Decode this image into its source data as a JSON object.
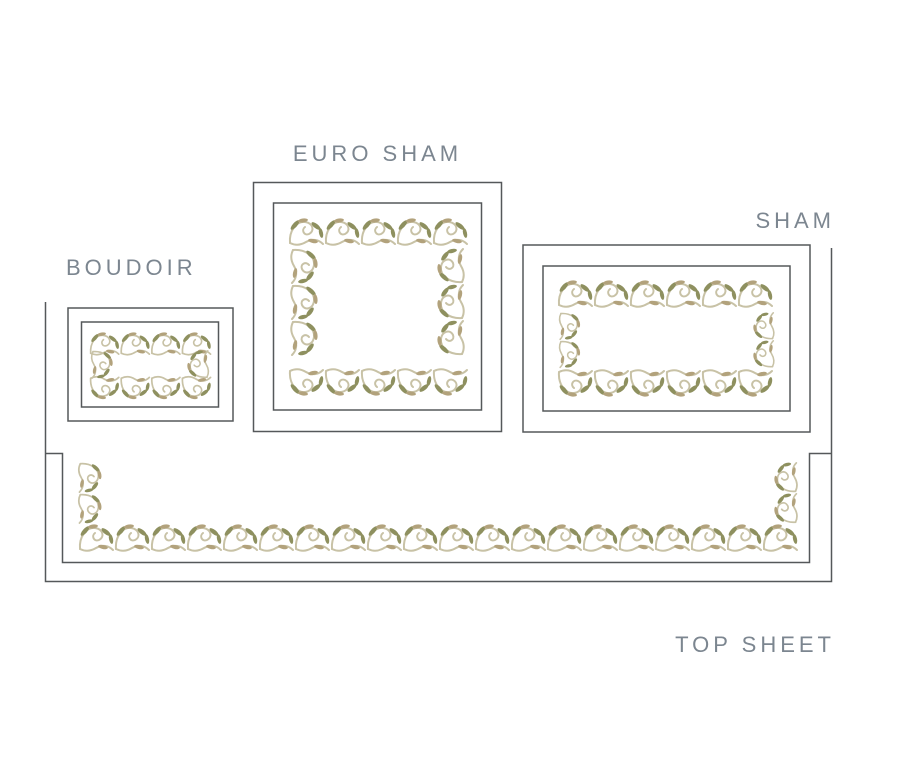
{
  "diagram": {
    "items": [
      {
        "id": "euro-sham",
        "label": "EURO SHAM"
      },
      {
        "id": "sham",
        "label": "SHAM"
      },
      {
        "id": "boudoir",
        "label": "BOUDOIR"
      },
      {
        "id": "top-sheet",
        "label": "TOP SHEET"
      }
    ],
    "colors": {
      "background": "#ffffff",
      "outline": "#55585a",
      "label_text": "#7c8690",
      "embroidery_outline": "#c8c2a6",
      "embroidery_olive": "#8e905f",
      "embroidery_tan": "#b2a27c"
    }
  }
}
